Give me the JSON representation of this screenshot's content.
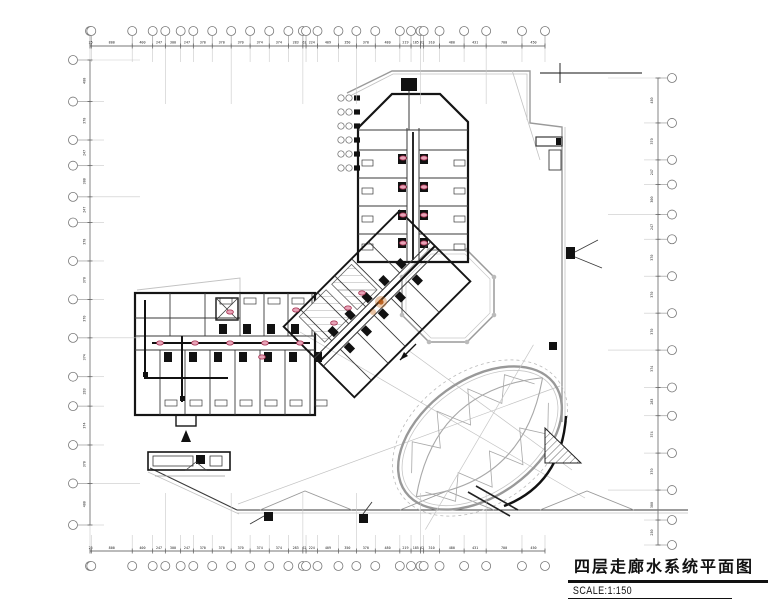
{
  "title_block": {
    "title": "四层走廊水系统平面图",
    "scale": "SCALE:1:150"
  },
  "grids": {
    "top": {
      "dims": [
        "25",
        "800",
        "400",
        "247",
        "300",
        "247",
        "370",
        "370",
        "370",
        "374",
        "374",
        "283",
        "62",
        "224",
        "409",
        "350",
        "370",
        "480",
        "219",
        "185",
        "62",
        "310",
        "480",
        "431",
        "700",
        "450"
      ]
    },
    "bottom": {
      "dims": [
        "25",
        "800",
        "400",
        "247",
        "300",
        "247",
        "370",
        "370",
        "370",
        "374",
        "374",
        "283",
        "62",
        "224",
        "409",
        "350",
        "370",
        "480",
        "219",
        "185",
        "62",
        "310",
        "480",
        "431",
        "700",
        "450"
      ]
    },
    "left": {
      "dims": [
        "400",
        "370",
        "247",
        "300",
        "247",
        "370",
        "370",
        "370",
        "374",
        "283",
        "374",
        "370",
        "400"
      ]
    },
    "right": {
      "dims": [
        "450",
        "370",
        "247",
        "300",
        "247",
        "370",
        "370",
        "370",
        "374",
        "283",
        "374",
        "370",
        "300",
        "250"
      ]
    }
  },
  "colors": {
    "riser_marker_fill": "#e8a4b8",
    "riser_marker_stroke": "#a43050",
    "accent_orange": "#c96a1a",
    "grid_gray": "#9a9a9a",
    "wall_black": "#151515"
  },
  "symbols": {
    "riser_marker": "pipe-riser-marker",
    "detail_flag": "detail-flag-symbol",
    "grid_bubble": "column-grid-bubble"
  }
}
